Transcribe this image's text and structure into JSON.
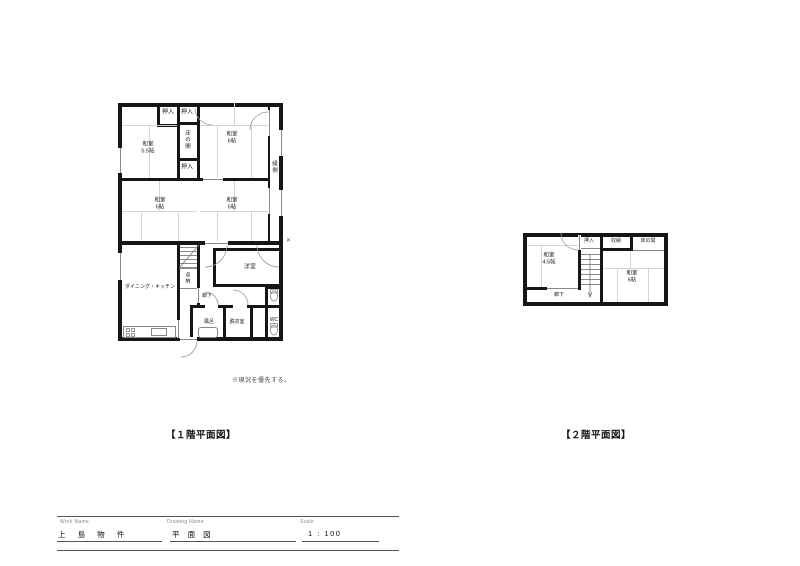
{
  "colors": {
    "wall": "#161616",
    "thin_line": "#8a8a8a",
    "tatami_line": "#d4d4d4"
  },
  "floor1": {
    "caption": "【１階平面図】",
    "note": "※現況を優先する。",
    "rooms": {
      "closet_top_left": "押入",
      "closet_top_mid": "押入",
      "tokonoma": "床の間",
      "closet_mid": "押入",
      "washitsu_55": "和室",
      "washitsu_55_size": "5.5帖",
      "washitsu_top_right": "和室",
      "washitsu_top_right_size": "6帖",
      "engawa": "縁側",
      "washitsu_mid_left": "和室",
      "washitsu_mid_left_size": "6帖",
      "washitsu_mid_right": "和室",
      "washitsu_mid_right_size": "6帖",
      "dining_kitchen": "ダイニング・キッチン",
      "storage": "収納",
      "hallway": "廊下",
      "western_room": "洋室",
      "bath": "風呂",
      "dressing_room": "脱衣室",
      "toilet": "WC"
    }
  },
  "floor2": {
    "caption": "【２階平面図】",
    "rooms": {
      "closet": "押入",
      "storage": "収納",
      "tokonoma": "床の間",
      "washitsu_45": "和室",
      "washitsu_45_size": "4.5帖",
      "washitsu_6": "和室",
      "washitsu_6_size": "6帖",
      "hallway": "廊下"
    }
  },
  "titleblock": {
    "work_name_label": "Work Name",
    "work_name_value": "上 島 物 件",
    "drawing_name_label": "Drawing Name",
    "drawing_name_value": "平 面 図",
    "scale_label": "Scale",
    "scale_value": "1 : 100"
  }
}
